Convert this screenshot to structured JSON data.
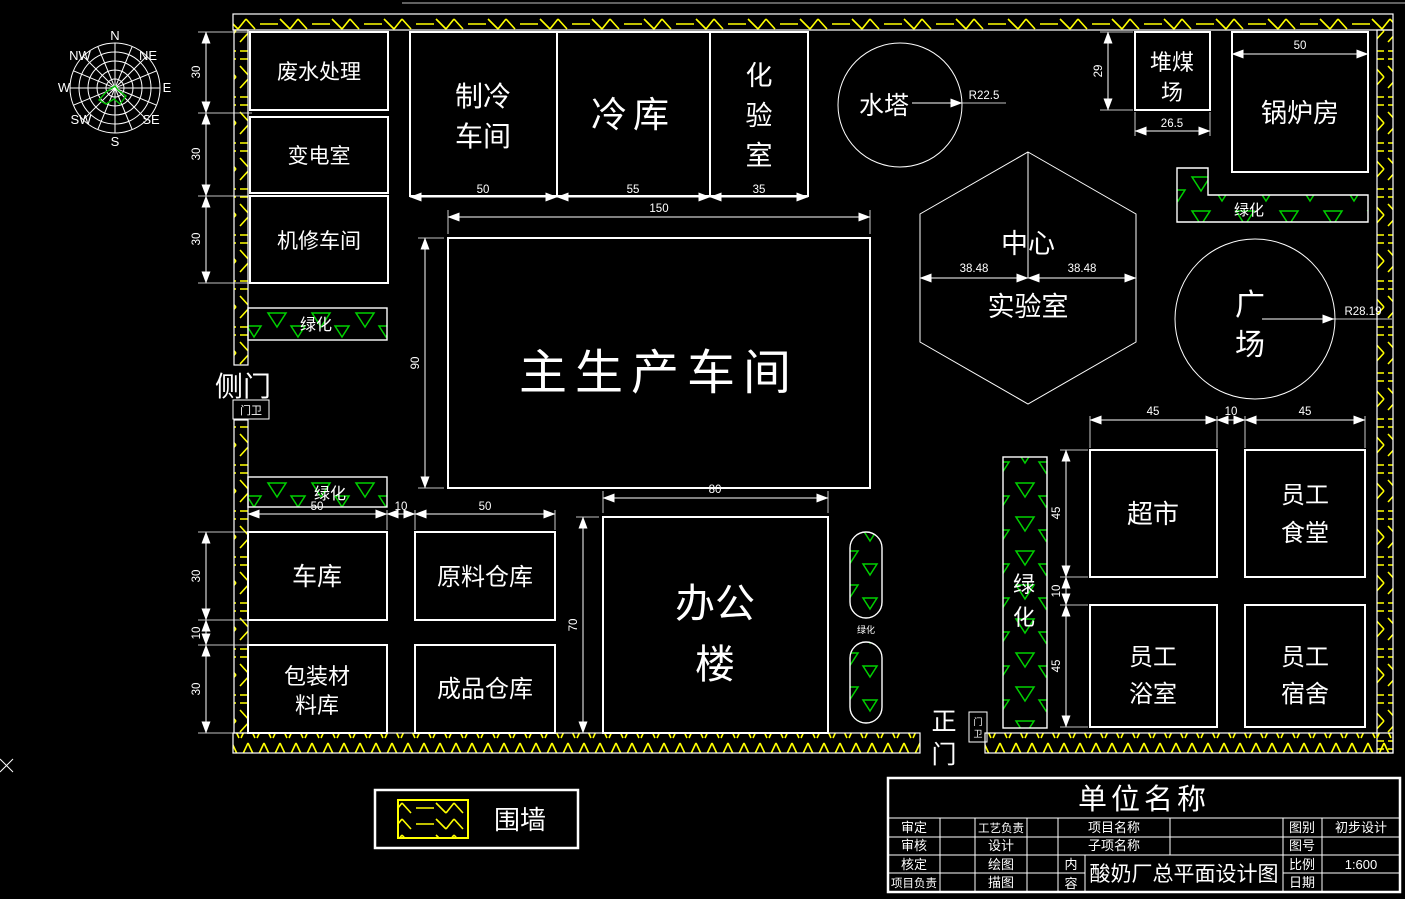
{
  "meta": {
    "bg": "#000000",
    "line_color": "#ffffff",
    "wall_color": "#ffff00",
    "green_color": "#00d000"
  },
  "compass": {
    "n": "N",
    "ne": "NE",
    "e": "E",
    "se": "SE",
    "s": "S",
    "sw": "SW",
    "w": "W",
    "nw": "NW"
  },
  "buildings": {
    "wastewater": {
      "label": "废水处理"
    },
    "substation": {
      "label": "变电室"
    },
    "repair": {
      "label": "机修车间"
    },
    "refrigeration": {
      "line1": "制冷",
      "line2": "车间"
    },
    "cold_storage": {
      "label": "冷库"
    },
    "test_lab": {
      "c1": "化",
      "c2": "验",
      "c3": "室"
    },
    "water_tower": {
      "label": "水塔"
    },
    "coal_yard": {
      "line1": "堆煤",
      "line2": "场"
    },
    "boiler": {
      "label": "锅炉房"
    },
    "central_lab": {
      "line1": "中心",
      "line2": "实验室"
    },
    "main_workshop": {
      "label": "主生产车间"
    },
    "plaza": {
      "line1": "广",
      "line2": "场"
    },
    "garage": {
      "label": "车库"
    },
    "raw_warehouse": {
      "label": "原料仓库"
    },
    "packaging": {
      "line1": "包装材",
      "line2": "料库"
    },
    "finished_warehouse": {
      "label": "成品仓库"
    },
    "office": {
      "line1": "办公",
      "line2": "楼"
    },
    "supermarket": {
      "label": "超市"
    },
    "canteen": {
      "line1": "员工",
      "line2": "食堂"
    },
    "bathhouse": {
      "line1": "员工",
      "line2": "浴室"
    },
    "dormitory": {
      "line1": "员工",
      "line2": "宿舍"
    }
  },
  "labels": {
    "greening": "绿化",
    "greening_c1": "绿",
    "greening_c2": "化",
    "side_gate": "侧门",
    "main_gate_c1": "正",
    "main_gate_c2": "门",
    "guard": "门卫",
    "guard_c1": "门",
    "guard_c2": "卫"
  },
  "dims": {
    "w1": "30",
    "w2": "30",
    "w3": "30",
    "refrig_w": "50",
    "cold_w": "55",
    "lab_w": "35",
    "main_w": "150",
    "main_h": "90",
    "tower_r": "R22.5",
    "coal_h": "29",
    "coal_w": "26.5",
    "boiler_w": "50",
    "hex_l": "38.48",
    "hex_r": "38.48",
    "plaza_r": "R28.19",
    "row1_a": "50",
    "row1_b": "10",
    "row1_c": "50",
    "col1_a": "30",
    "col1_b": "10",
    "col1_c": "30",
    "office_w": "80",
    "office_h": "70",
    "grid_w1": "45",
    "grid_w2": "10",
    "grid_w3": "45",
    "grid_h1": "45",
    "grid_h2": "10",
    "grid_h3": "45"
  },
  "legend": {
    "wall": "围墙"
  },
  "title_block": {
    "company": "单位名称",
    "r1c1": "审定",
    "r2c1": "审核",
    "r3c1": "核定",
    "r4c1": "项目负责",
    "r1c2": "工艺负责",
    "r2c2": "设计",
    "r3c2": "绘图",
    "r4c2": "描图",
    "project_name": "项目名称",
    "sub_name": "子项名称",
    "content_c1": "内",
    "content_c2": "容",
    "content": "酸奶厂总平面设计图",
    "r1c4": "图别",
    "r2c4": "图号",
    "r3c4": "比例",
    "r4c4": "日期",
    "category": "初步设计",
    "scale": "1:600"
  }
}
